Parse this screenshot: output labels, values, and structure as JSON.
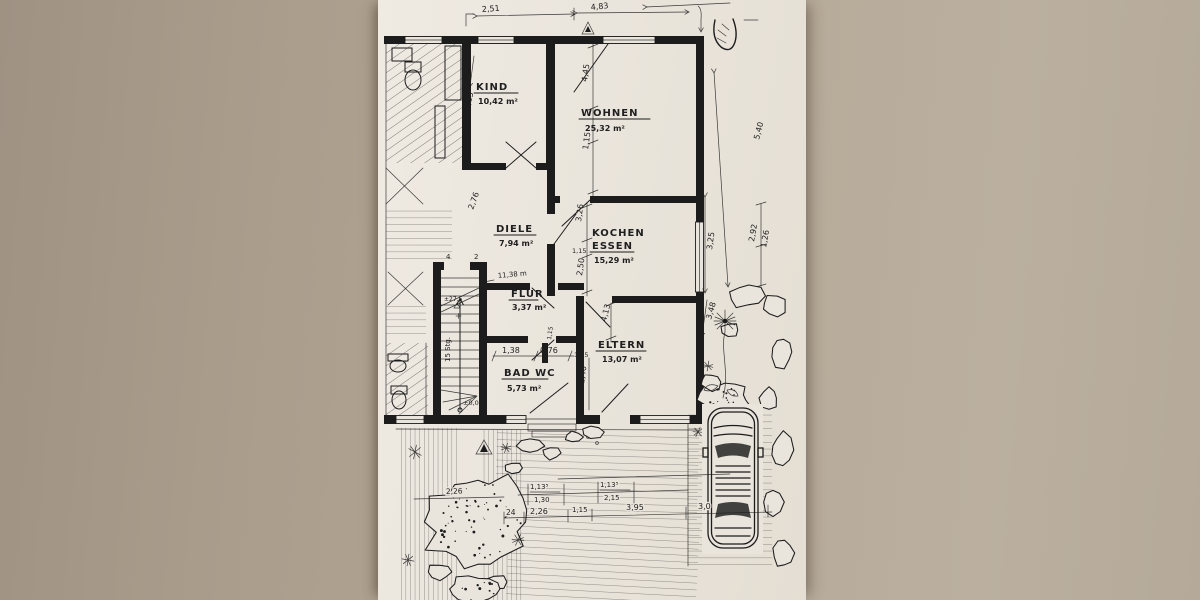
{
  "colors": {
    "desk": "#b3a695",
    "paper": "#eae5dc",
    "ink": "#1c1c1c"
  },
  "rooms": [
    {
      "name": "KIND",
      "area": "10,42 m²"
    },
    {
      "name": "WOHNEN",
      "area": "25,32 m²"
    },
    {
      "name": "DIELE",
      "area": "7,94 m²"
    },
    {
      "name": "KOCHEN",
      "name2": "ESSEN",
      "area": "15,29 m²"
    },
    {
      "name": "FLUR",
      "area": "3,37 m²"
    },
    {
      "name": "BAD WC",
      "area": "5,73 m²"
    },
    {
      "name": "ELTERN",
      "area": "13,07 m²"
    }
  ],
  "dims": {
    "top": [
      "2,51",
      "4,83"
    ],
    "right": [
      "5,40",
      "3,25",
      "2,92",
      "1,26",
      "3,48"
    ],
    "left": [
      "4,15",
      "2,76"
    ],
    "wohnen": [
      "4,45",
      "1,15"
    ],
    "kochen": [
      "3,26",
      "1,15",
      "2,50"
    ],
    "eltern": [
      "4,13",
      "1,15",
      "2,40"
    ],
    "bad": [
      "1,38",
      "0,76",
      "1,15"
    ],
    "bottom_upper": [
      "1,13⁵",
      "1,30",
      "1,13⁵",
      "2,15"
    ],
    "bottom_lower": [
      "24",
      "2,26",
      "1,15",
      "3,95",
      "3,0"
    ],
    "garden": [
      "2,26"
    ]
  },
  "stairs": {
    "steps": "15 Stg.",
    "level": "±0,00",
    "riser": "±27,5",
    "mark_left": "4",
    "mark_right": "2"
  },
  "notes": {
    "flur_length": "11,38 m"
  }
}
